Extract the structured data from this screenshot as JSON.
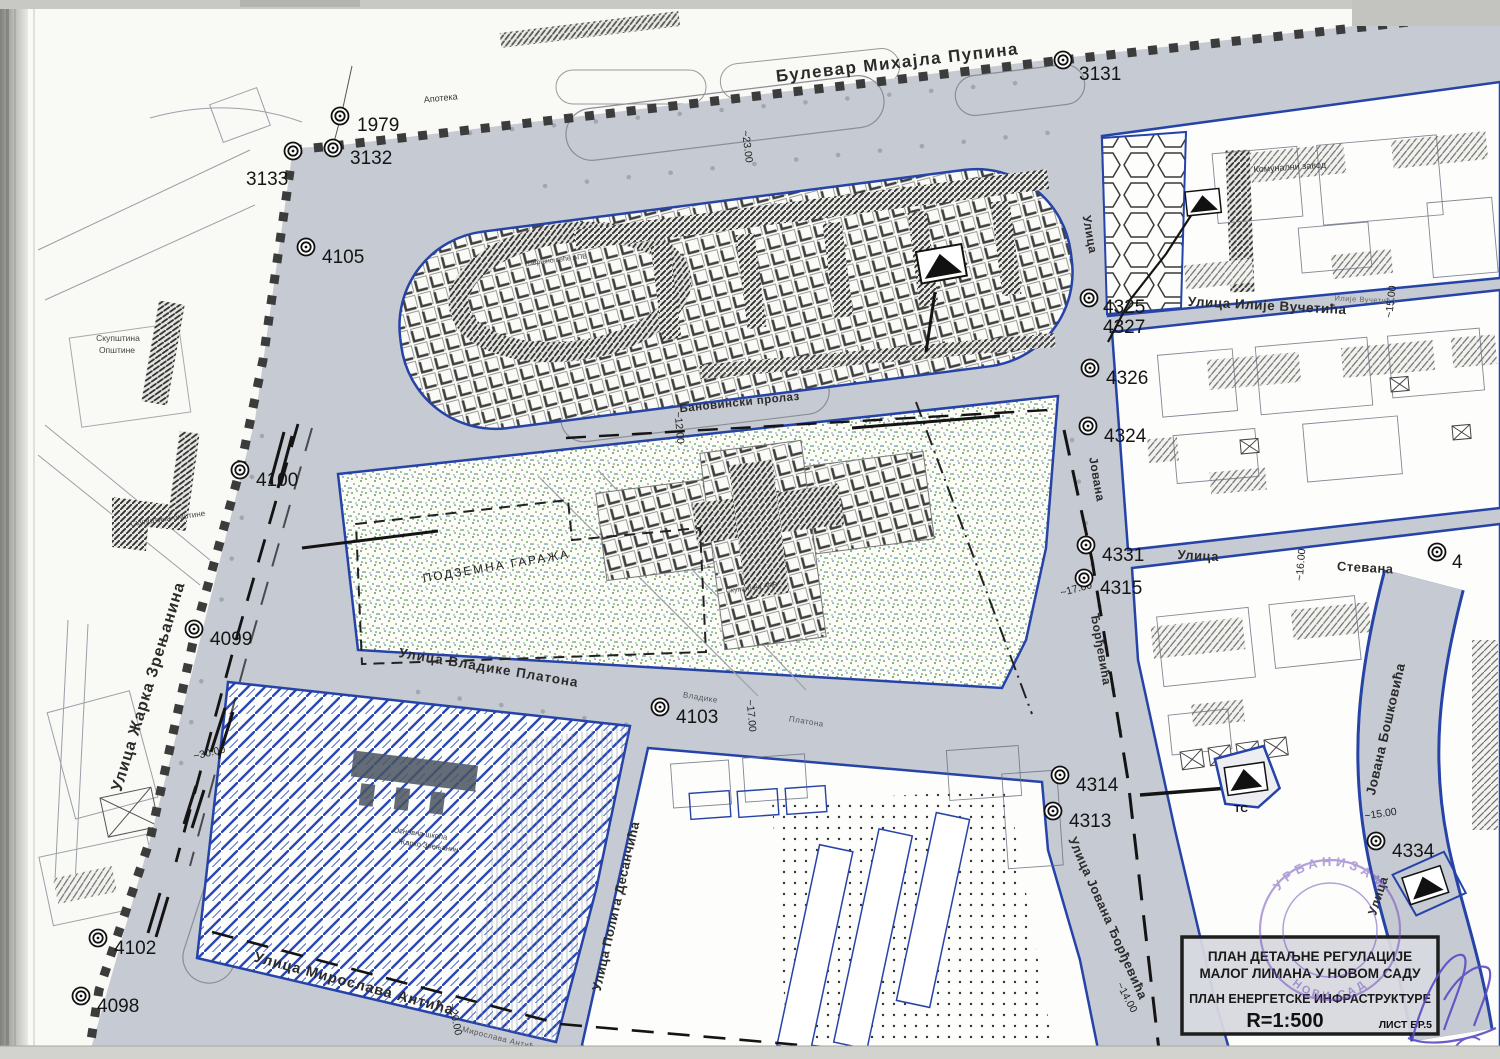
{
  "title_block": {
    "line1": "ПЛАН ДЕТАЉНЕ РЕГУЛАЦИЈЕ",
    "line2": "МАЛОГ ЛИМАНА У НОВОМ САДУ",
    "line3": "ПЛАН ЕНЕРГЕТСКЕ ИНФРАСТРУКТУРЕ",
    "scale": "R=1:500",
    "sheet": "ЛИСТ БР.5"
  },
  "stamp": {
    "arc_top": "УРБАНИЗАМ",
    "arc_bottom": "НОВИ САД"
  },
  "street_labels": [
    {
      "name": "street-label-bulevar-mihajla-pupina",
      "text": "Булевар Михајла Пупина",
      "x": 898,
      "y": 68,
      "rot": -6.5,
      "size": 17,
      "w": 700,
      "ls": 1.5,
      "fill": "#2b2b2b"
    },
    {
      "name": "street-label-zarka-zrenjanina",
      "text": "Улица Жарка Зрењанина",
      "x": 153,
      "y": 688,
      "rot": -73,
      "size": 16,
      "w": 700,
      "ls": 1,
      "fill": "#2b2b2b"
    },
    {
      "name": "street-label-miroslava-antica",
      "text": "Улица Мирослава Антића",
      "x": 353,
      "y": 988,
      "rot": 15,
      "size": 14.5,
      "w": 700,
      "ls": 1,
      "fill": "#2b2b2b"
    },
    {
      "name": "street-label-vladike-platona",
      "text": "Улица Владике Платона",
      "x": 488,
      "y": 672,
      "rot": 9.5,
      "size": 13.5,
      "w": 700,
      "ls": 1,
      "fill": "#2b2b2b"
    },
    {
      "name": "street-label-banovinski-prolaz",
      "text": "Бановински пролаз",
      "x": 740,
      "y": 406,
      "rot": -6,
      "size": 11.5,
      "w": 700,
      "ls": 0.5,
      "fill": "#2b2b2b"
    },
    {
      "name": "street-label-ilije-vucetica",
      "text": "Улица Илије Вучетића",
      "x": 1267,
      "y": 310,
      "rot": 3,
      "size": 13.5,
      "w": 700,
      "ls": 0.5,
      "fill": "#2b2b2b"
    },
    {
      "name": "street-label-ulica-stevana-1",
      "text": "Улица",
      "x": 1198,
      "y": 560,
      "rot": 3,
      "size": 13,
      "w": 700,
      "ls": 0.5,
      "fill": "#2b2b2b"
    },
    {
      "name": "street-label-ulica-stevana-2",
      "text": "Стевана",
      "x": 1365,
      "y": 572,
      "rot": 3,
      "size": 13,
      "w": 700,
      "ls": 0.5,
      "fill": "#2b2b2b"
    },
    {
      "name": "street-label-polita-desancica",
      "text": "Улица Полита Десанчића",
      "x": 620,
      "y": 907,
      "rot": -77,
      "size": 13,
      "w": 700,
      "ls": 0.5,
      "fill": "#2b2b2b"
    },
    {
      "name": "street-label-jovana-djordjevica",
      "text": "Улица Јована  Ђорђевића",
      "x": 1104,
      "y": 920,
      "rot": 66,
      "size": 13,
      "w": 700,
      "ls": 0.5,
      "fill": "#2b2b2b"
    },
    {
      "name": "street-label-jovana-upper",
      "text": "Јована",
      "x": 1093,
      "y": 480,
      "rot": 80,
      "size": 12,
      "w": 700,
      "ls": 0.5,
      "fill": "#2b2b2b"
    },
    {
      "name": "street-label-djordjevica-upper",
      "text": "Ђорђевића",
      "x": 1097,
      "y": 650,
      "rot": 80,
      "size": 12,
      "w": 700,
      "ls": 0.5,
      "fill": "#2b2b2b"
    },
    {
      "name": "street-label-ulica-top-right",
      "text": "Улица",
      "x": 1086,
      "y": 235,
      "rot": 80,
      "size": 12,
      "w": 700,
      "ls": 0.5,
      "fill": "#2b2b2b"
    },
    {
      "name": "street-label-jovana-boskovica",
      "text": "Јована Бошковића",
      "x": 1390,
      "y": 730,
      "rot": -77,
      "size": 13.5,
      "w": 700,
      "ls": 0.5,
      "fill": "#2b2b2b"
    },
    {
      "name": "street-label-ulica-boskovica",
      "text": "Улица",
      "x": 1382,
      "y": 897,
      "rot": -72,
      "size": 12.5,
      "w": 700,
      "ls": 0.5,
      "fill": "#2b2b2b"
    },
    {
      "name": "street-label-minor-vladike",
      "text": "Владике",
      "x": 700,
      "y": 700,
      "rot": 9,
      "size": 8,
      "w": 400,
      "ls": 0.5,
      "fill": "#555555"
    },
    {
      "name": "street-label-minor-platona",
      "text": "Платона",
      "x": 806,
      "y": 724,
      "rot": 9,
      "size": 8,
      "w": 400,
      "ls": 0.5,
      "fill": "#555555"
    },
    {
      "name": "street-label-minor-miroslava",
      "text": "Мирослава Антића",
      "x": 500,
      "y": 1041,
      "rot": 14,
      "size": 8,
      "w": 400,
      "ls": 0.5,
      "fill": "#555555"
    },
    {
      "name": "street-label-minor-ilije",
      "text": "Илије Вучетића",
      "x": 1365,
      "y": 302,
      "rot": 3,
      "size": 7.5,
      "w": 400,
      "ls": 0.5,
      "fill": "#666666"
    }
  ],
  "area_labels": [
    {
      "name": "area-label-apoteka",
      "text": "Апотека",
      "x": 441,
      "y": 101,
      "rot": -6,
      "size": 9,
      "w": 400,
      "fill": "#333333"
    },
    {
      "name": "area-label-skupstina-1",
      "text": "Скупштина",
      "x": 118,
      "y": 341,
      "rot": 0,
      "size": 8.5,
      "w": 400,
      "fill": "#444444"
    },
    {
      "name": "area-label-skupstina-2",
      "text": "Општине",
      "x": 117,
      "y": 353,
      "rot": 0,
      "size": 8.5,
      "w": 400,
      "fill": "#444444"
    },
    {
      "name": "area-label-skupstina-opstine",
      "text": "Скупштина општине",
      "x": 168,
      "y": 521,
      "rot": -8,
      "size": 8,
      "w": 400,
      "fill": "#444444"
    },
    {
      "name": "area-label-komunalni-zavod",
      "text": "Комунални завод",
      "x": 1290,
      "y": 170,
      "rot": -4,
      "size": 9,
      "w": 400,
      "fill": "#333333"
    },
    {
      "name": "area-label-podzemna-garaza",
      "text": "ПОДЗЕМНА ГАРАЖА",
      "x": 497,
      "y": 570,
      "rot": -9.5,
      "size": 12,
      "w": 400,
      "ls": 2,
      "fill": "#222222"
    },
    {
      "name": "area-label-ts",
      "text": "ТС",
      "x": 1241,
      "y": 812,
      "rot": 0,
      "size": 10.5,
      "w": 700,
      "fill": "#111111"
    },
    {
      "name": "area-label-izvrsno-vece",
      "text": "Извршно веће АПВ",
      "x": 556,
      "y": 262,
      "rot": -7,
      "size": 7,
      "w": 400,
      "fill": "#454545"
    },
    {
      "name": "area-label-skupstina-apv",
      "text": "Скупштина АПВ",
      "x": 752,
      "y": 590,
      "rot": -7,
      "size": 7,
      "w": 400,
      "fill": "#454545"
    },
    {
      "name": "area-label-skola-1",
      "text": "Основна школа",
      "x": 420,
      "y": 836,
      "rot": 8,
      "size": 7.5,
      "w": 400,
      "fill": "#333a44"
    },
    {
      "name": "area-label-skola-2",
      "text": "Жарко Зрењанин",
      "x": 428,
      "y": 848,
      "rot": 8,
      "size": 7.5,
      "w": 400,
      "fill": "#333a44"
    }
  ],
  "measurements": [
    {
      "text": "~23.00",
      "x": 744,
      "y": 147,
      "rot": 83
    },
    {
      "text": "~12.00",
      "x": 676,
      "y": 428,
      "rot": 85
    },
    {
      "text": "~15.00",
      "x": 1394,
      "y": 302,
      "rot": -83
    },
    {
      "text": "~16.00",
      "x": 1304,
      "y": 565,
      "rot": -85
    },
    {
      "text": "~17.00",
      "x": 1077,
      "y": 592,
      "rot": -15
    },
    {
      "text": "~17.00",
      "x": 748,
      "y": 716,
      "rot": 85
    },
    {
      "text": "~30.00",
      "x": 210,
      "y": 756,
      "rot": -13
    },
    {
      "text": "~20.00",
      "x": 452,
      "y": 1020,
      "rot": 78
    },
    {
      "text": "~14.00",
      "x": 1124,
      "y": 999,
      "rot": 62
    },
    {
      "text": "~15.00",
      "x": 1381,
      "y": 817,
      "rot": -8
    }
  ],
  "points": [
    {
      "label": "1979",
      "x": 340,
      "y": 116,
      "lx": 357,
      "ly": 124
    },
    {
      "label": "3132",
      "x": 333,
      "y": 148,
      "lx": 350,
      "ly": 157
    },
    {
      "label": "3133",
      "x": 293,
      "y": 151,
      "lx": 246,
      "ly": 178
    },
    {
      "label": "3131",
      "x": 1063,
      "y": 60,
      "lx": 1079,
      "ly": 73
    },
    {
      "label": "4105",
      "x": 306,
      "y": 247,
      "lx": 322,
      "ly": 256
    },
    {
      "label": "4100",
      "x": 240,
      "y": 470,
      "lx": 256,
      "ly": 479
    },
    {
      "label": "4099",
      "x": 194,
      "y": 629,
      "lx": 210,
      "ly": 638
    },
    {
      "label": "4102",
      "x": 98,
      "y": 938,
      "lx": 114,
      "ly": 947
    },
    {
      "label": "4098",
      "x": 81,
      "y": 996,
      "lx": 97,
      "ly": 1005
    },
    {
      "label": "4103",
      "x": 660,
      "y": 707,
      "lx": 676,
      "ly": 716
    },
    {
      "label": "4325",
      "x": 1089,
      "y": 298,
      "lx": 1103,
      "ly": 306
    },
    {
      "label": "4327",
      "marker": false,
      "lx": 1103,
      "ly": 326
    },
    {
      "label": "4326",
      "x": 1090,
      "y": 368,
      "lx": 1106,
      "ly": 377
    },
    {
      "label": "4324",
      "x": 1088,
      "y": 426,
      "lx": 1104,
      "ly": 435
    },
    {
      "label": "4331",
      "x": 1086,
      "y": 545,
      "lx": 1102,
      "ly": 554
    },
    {
      "label": "4315",
      "x": 1084,
      "y": 578,
      "lx": 1100,
      "ly": 587
    },
    {
      "label": "4314",
      "x": 1060,
      "y": 775,
      "lx": 1076,
      "ly": 784
    },
    {
      "label": "4313",
      "x": 1053,
      "y": 811,
      "lx": 1069,
      "ly": 820
    },
    {
      "label": "4334",
      "x": 1376,
      "y": 841,
      "lx": 1392,
      "ly": 850
    },
    {
      "label": "4",
      "x": 1437,
      "y": 552,
      "lx": 1452,
      "ly": 561
    }
  ],
  "colors": {
    "street_gray": "#c6cad2",
    "block_outline_blue": "#2643a8",
    "hatch_blue": "#2847b8",
    "boundary_dark": "#3c3c3c",
    "green_dot": "#3e8e41",
    "stamp_purple": "#6a46bb",
    "signature_purple": "#5b4bc4",
    "paper": "#f8f8f5",
    "title_bg": "#d7d9df"
  }
}
